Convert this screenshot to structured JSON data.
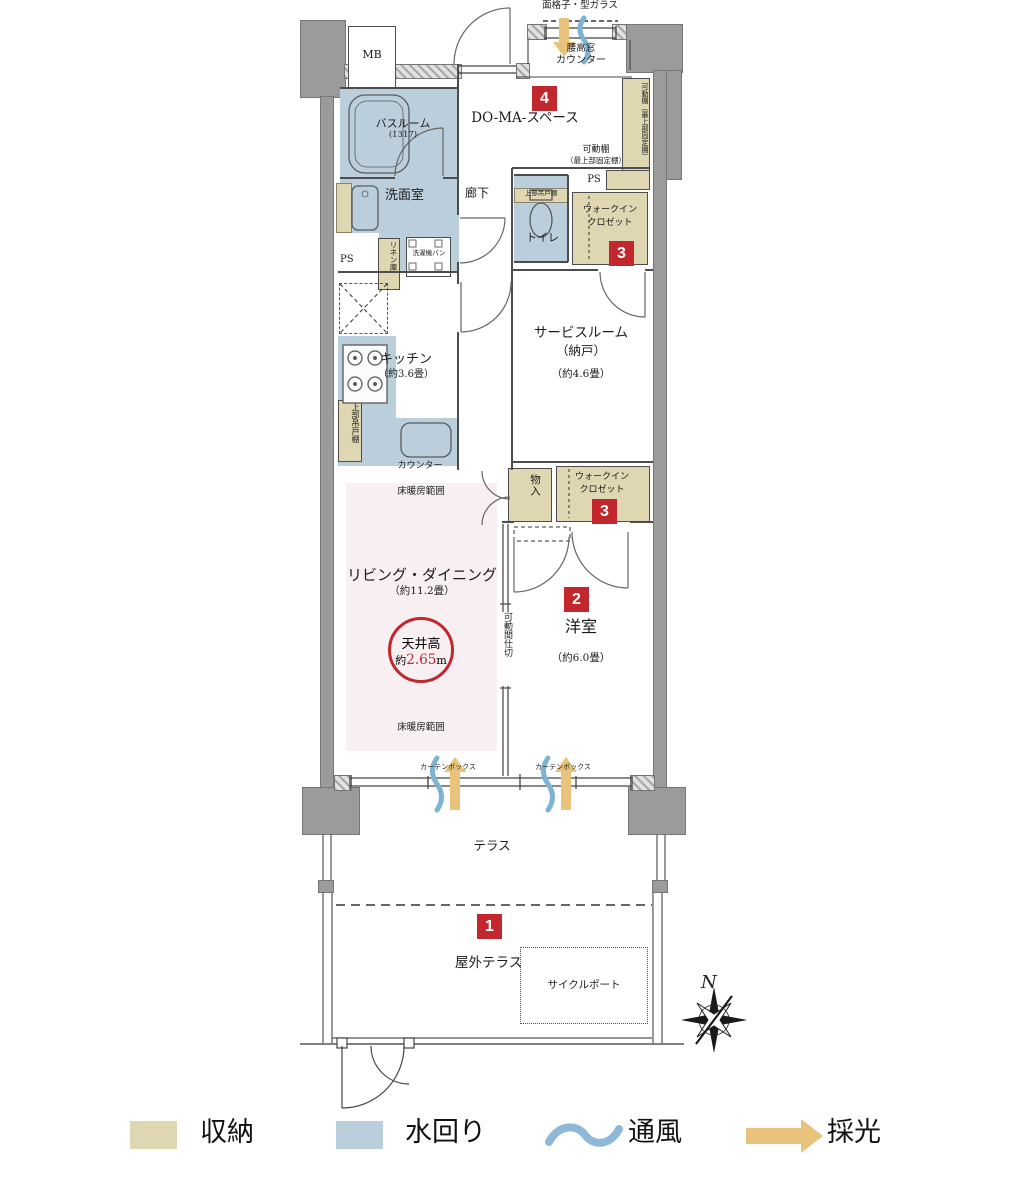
{
  "colors": {
    "wall": "#9b9b9b",
    "storage": "#ded7b2",
    "water": "#bacfdb",
    "floor_heating": "#f7eff2",
    "badge_red": "#c1272d",
    "ventilation_blue": "#7fb3d3",
    "daylight_tan": "#e9c37c"
  },
  "labels": {
    "mb": "MB",
    "grille": "面格子・型ガラス",
    "window_high": "腰高窓",
    "counter_top": "カウンター",
    "badge4": "4",
    "doma": "DO-MA-スペース",
    "shelf_v": "可動棚（最上部固定棚）",
    "shelf_h1": "可動棚",
    "shelf_h2": "（最上部固定棚）",
    "ps_right": "PS",
    "bath_name": "バスルーム",
    "bath_size": "(1317)",
    "washroom": "洗面室",
    "corridor": "廊下",
    "toilet_upper": "上部吊戸棚",
    "toilet": "トイレ",
    "wic1_l1": "ウォークイン",
    "wic1_l2": "クロゼット",
    "badge3a": "3",
    "linen": "リネン庫",
    "washer_pan": "洗濯機パン",
    "ps_left": "PS",
    "kitchen_name": "キッチン",
    "kitchen_size": "（約3.6畳）",
    "kitchen_upper": "上部吊戸棚",
    "counter_bottom": "カウンター",
    "service_l1": "サービスルーム",
    "service_l2": "（納戸）",
    "service_size": "（約4.6畳）",
    "storage_small": "物入",
    "wic2_l1": "ウォークイン",
    "wic2_l2": "クロゼット",
    "badge3b": "3",
    "heating_top": "床暖房範囲",
    "living_name": "リビング・ダイニング",
    "living_size": "（約11.2畳）",
    "ceiling_l1": "天井高",
    "ceiling_prefix": "約",
    "ceiling_value": "2.65",
    "ceiling_unit": "m",
    "heating_bottom": "床暖房範囲",
    "partition": "可動間仕切",
    "badge2": "2",
    "western_name": "洋室",
    "western_size": "（約6.0畳）",
    "curtain_left": "カーテンボックス",
    "curtain_right": "カーテンボックス",
    "terrace": "テラス",
    "badge1": "1",
    "outdoor_terrace": "屋外テラス",
    "cycle_port": "サイクルポート",
    "compass_n": "N"
  },
  "legend": {
    "items": [
      {
        "label": "収納",
        "swatch": "#ded7b2"
      },
      {
        "label": "水回り",
        "swatch": "#bacfdb"
      },
      {
        "label": "通風",
        "icon": "wave"
      },
      {
        "label": "採光",
        "icon": "arrow"
      }
    ]
  }
}
